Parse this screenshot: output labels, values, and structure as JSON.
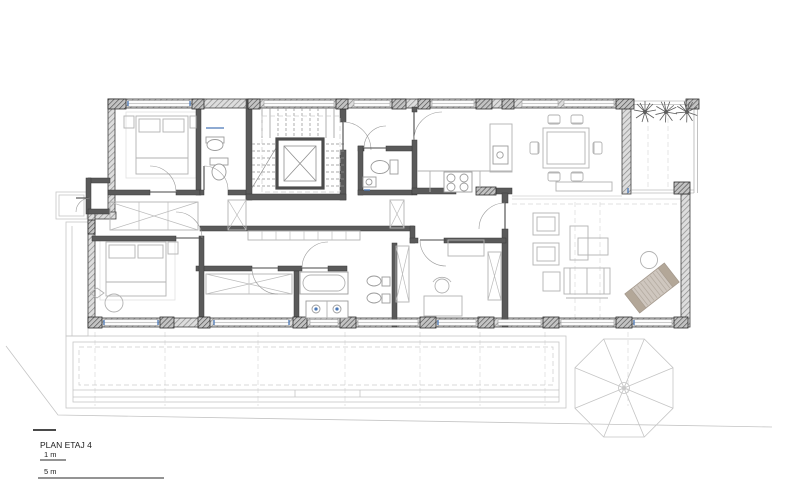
{
  "title_block": {
    "title": "PLAN ETAJ 4",
    "scale_bar_1m_label": "1 m",
    "scale_bar_5m_label": "5 m"
  },
  "drawing": {
    "type": "architectural floor plan",
    "floor_label": "ETAJ 4",
    "rooms": [
      "bedroom-1",
      "bathroom-1",
      "stair-core",
      "elevator",
      "entry-hall",
      "wc",
      "kitchen",
      "dining-area",
      "roof-terrace-palms",
      "living-room",
      "office",
      "bathroom-2",
      "dressing-room",
      "bedroom-2",
      "corridor",
      "balcony",
      "south-terrace-deck"
    ],
    "furniture_symbols": [
      "double-bed",
      "nightstand",
      "wardrobe",
      "dining-table-6-chairs",
      "sideboard",
      "sofa",
      "armchair",
      "chaise",
      "coffee-table",
      "round-side-table",
      "sun-lounger",
      "bathtub",
      "double-washbasin",
      "toilet",
      "bidet",
      "washbasin",
      "stove-4-burner",
      "kitchen-counter",
      "desk",
      "desk-chair",
      "palm-tree",
      "parasol-umbrella"
    ]
  },
  "colors": {
    "background": "#ffffff",
    "wall_gray": "#8a8a8a",
    "wall_dark": "#3f3f3f",
    "furniture_line": "#b2b2b2",
    "window_accent_blue": "#4a78b8",
    "lounger_tan": "#b3a798",
    "text": "#1c1c1c"
  }
}
